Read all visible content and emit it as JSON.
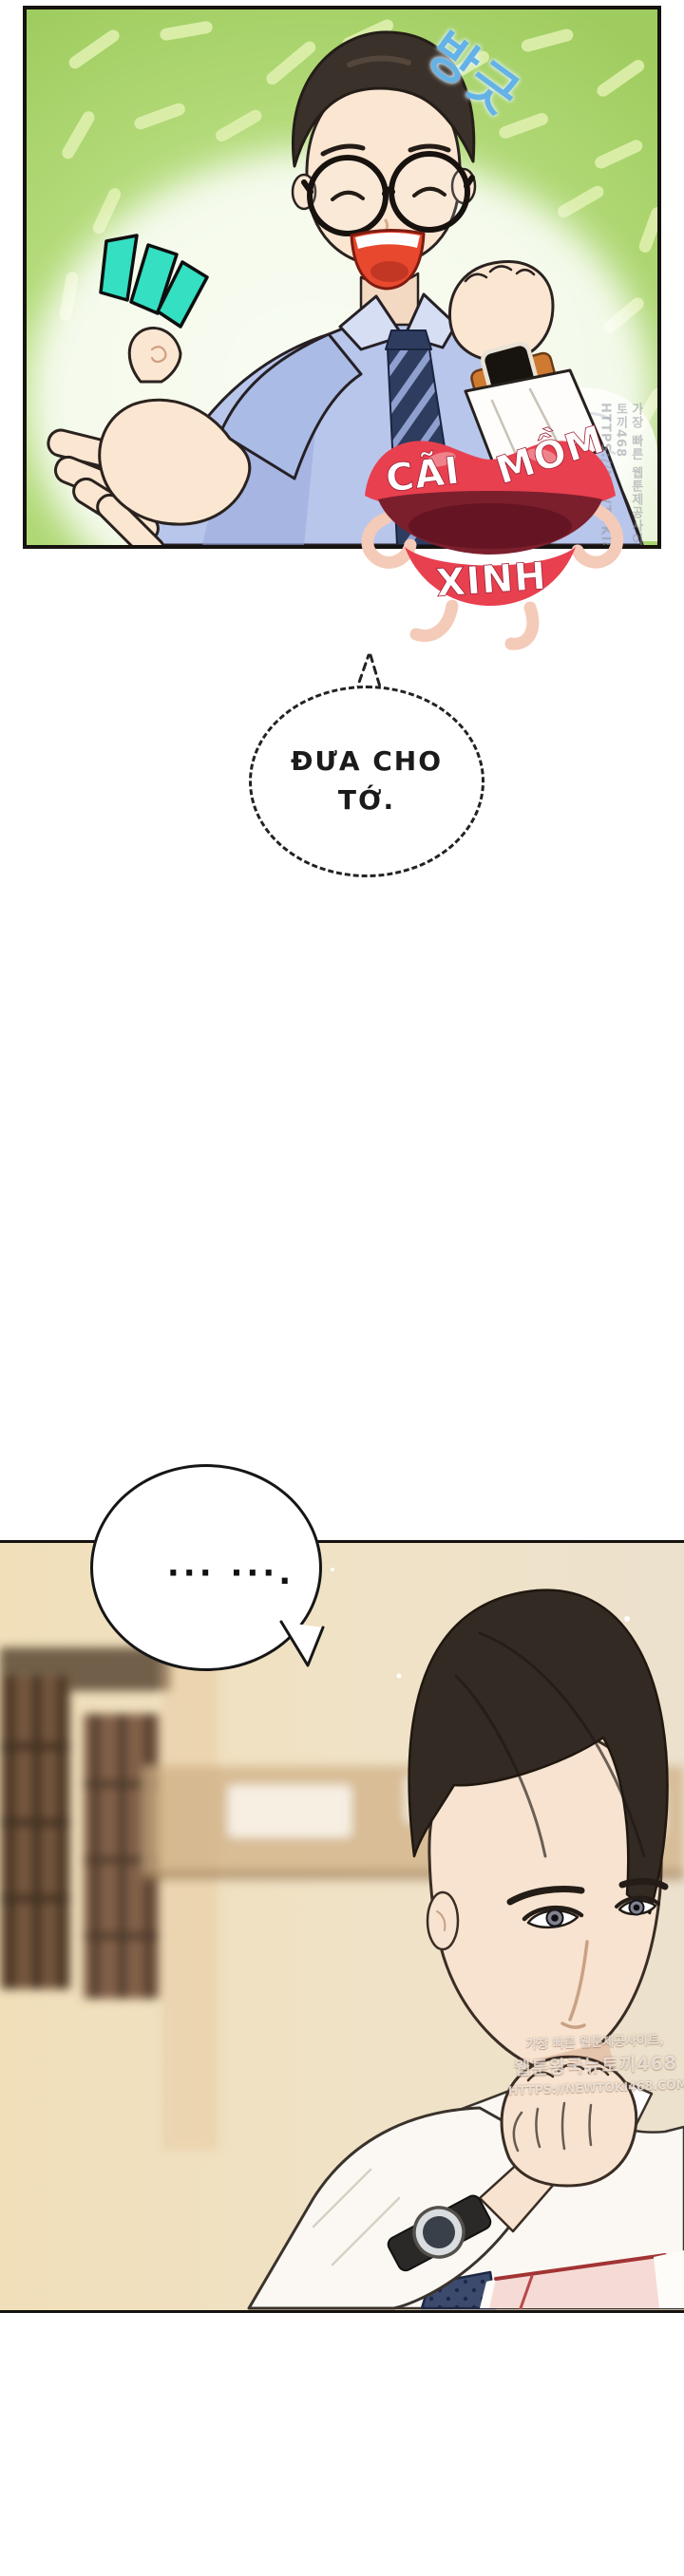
{
  "page": {
    "kind": "webtoon comic page",
    "background": "#ffffff"
  },
  "panel_top": {
    "sfx_text": "방긋",
    "sfx_color": "#64b2e6",
    "background_green": "#aed672",
    "emphasis_marks_color": "#35dfc1"
  },
  "translator_logo": {
    "word_top_left": "CÃI",
    "word_top_right": "MỒM",
    "word_bottom": "XINH",
    "lips_color": "#e8404f"
  },
  "speech_bubbles": {
    "dashed": {
      "line1": "ĐƯA CHO",
      "line2": "TỚ."
    },
    "ellipsis": {
      "text": "··· ···."
    }
  },
  "watermarks": {
    "line1": "가장 빠른 웹툰제공사이트,",
    "line2": "웹툰왕국뉴토끼468",
    "line3": "HTTPS://NEWTOKI468.COM"
  },
  "panel_bottom": {
    "background_tan": "#f1e2c2",
    "tie_navy": "#3c4a6e",
    "folder_pink": "#f6dad5"
  }
}
